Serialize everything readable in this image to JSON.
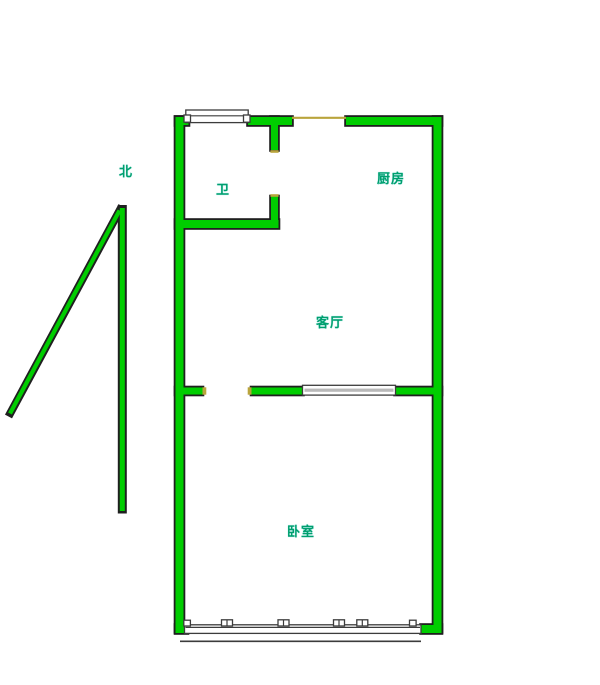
{
  "compass": {
    "label": "北",
    "icon": "north-arrow-icon"
  },
  "rooms": {
    "bathroom": {
      "label": "卫"
    },
    "kitchen": {
      "label": "厨房"
    },
    "living_room": {
      "label": "客厅"
    },
    "bedroom": {
      "label": "卧室"
    }
  },
  "features": [
    {
      "name": "top-window",
      "location": "top wall above bathroom"
    },
    {
      "name": "kitchen-door-opening",
      "location": "top wall, marked by thin yellow line"
    },
    {
      "name": "bathroom-door-opening",
      "location": "right wall of bathroom"
    },
    {
      "name": "partition-window",
      "location": "wall between living room and bedroom"
    },
    {
      "name": "bedroom-window-band",
      "location": "bottom wall with mullions and outer sill line"
    }
  ],
  "colors": {
    "wall-green": "#00CD00",
    "wall-outline": "#1f1f1f",
    "window-outline": "#3c3c3c",
    "door-accent": "#B9A43C",
    "window-gray": "#B9B9B9",
    "label-green": "#009F6E",
    "background": "#FFFFFF"
  }
}
